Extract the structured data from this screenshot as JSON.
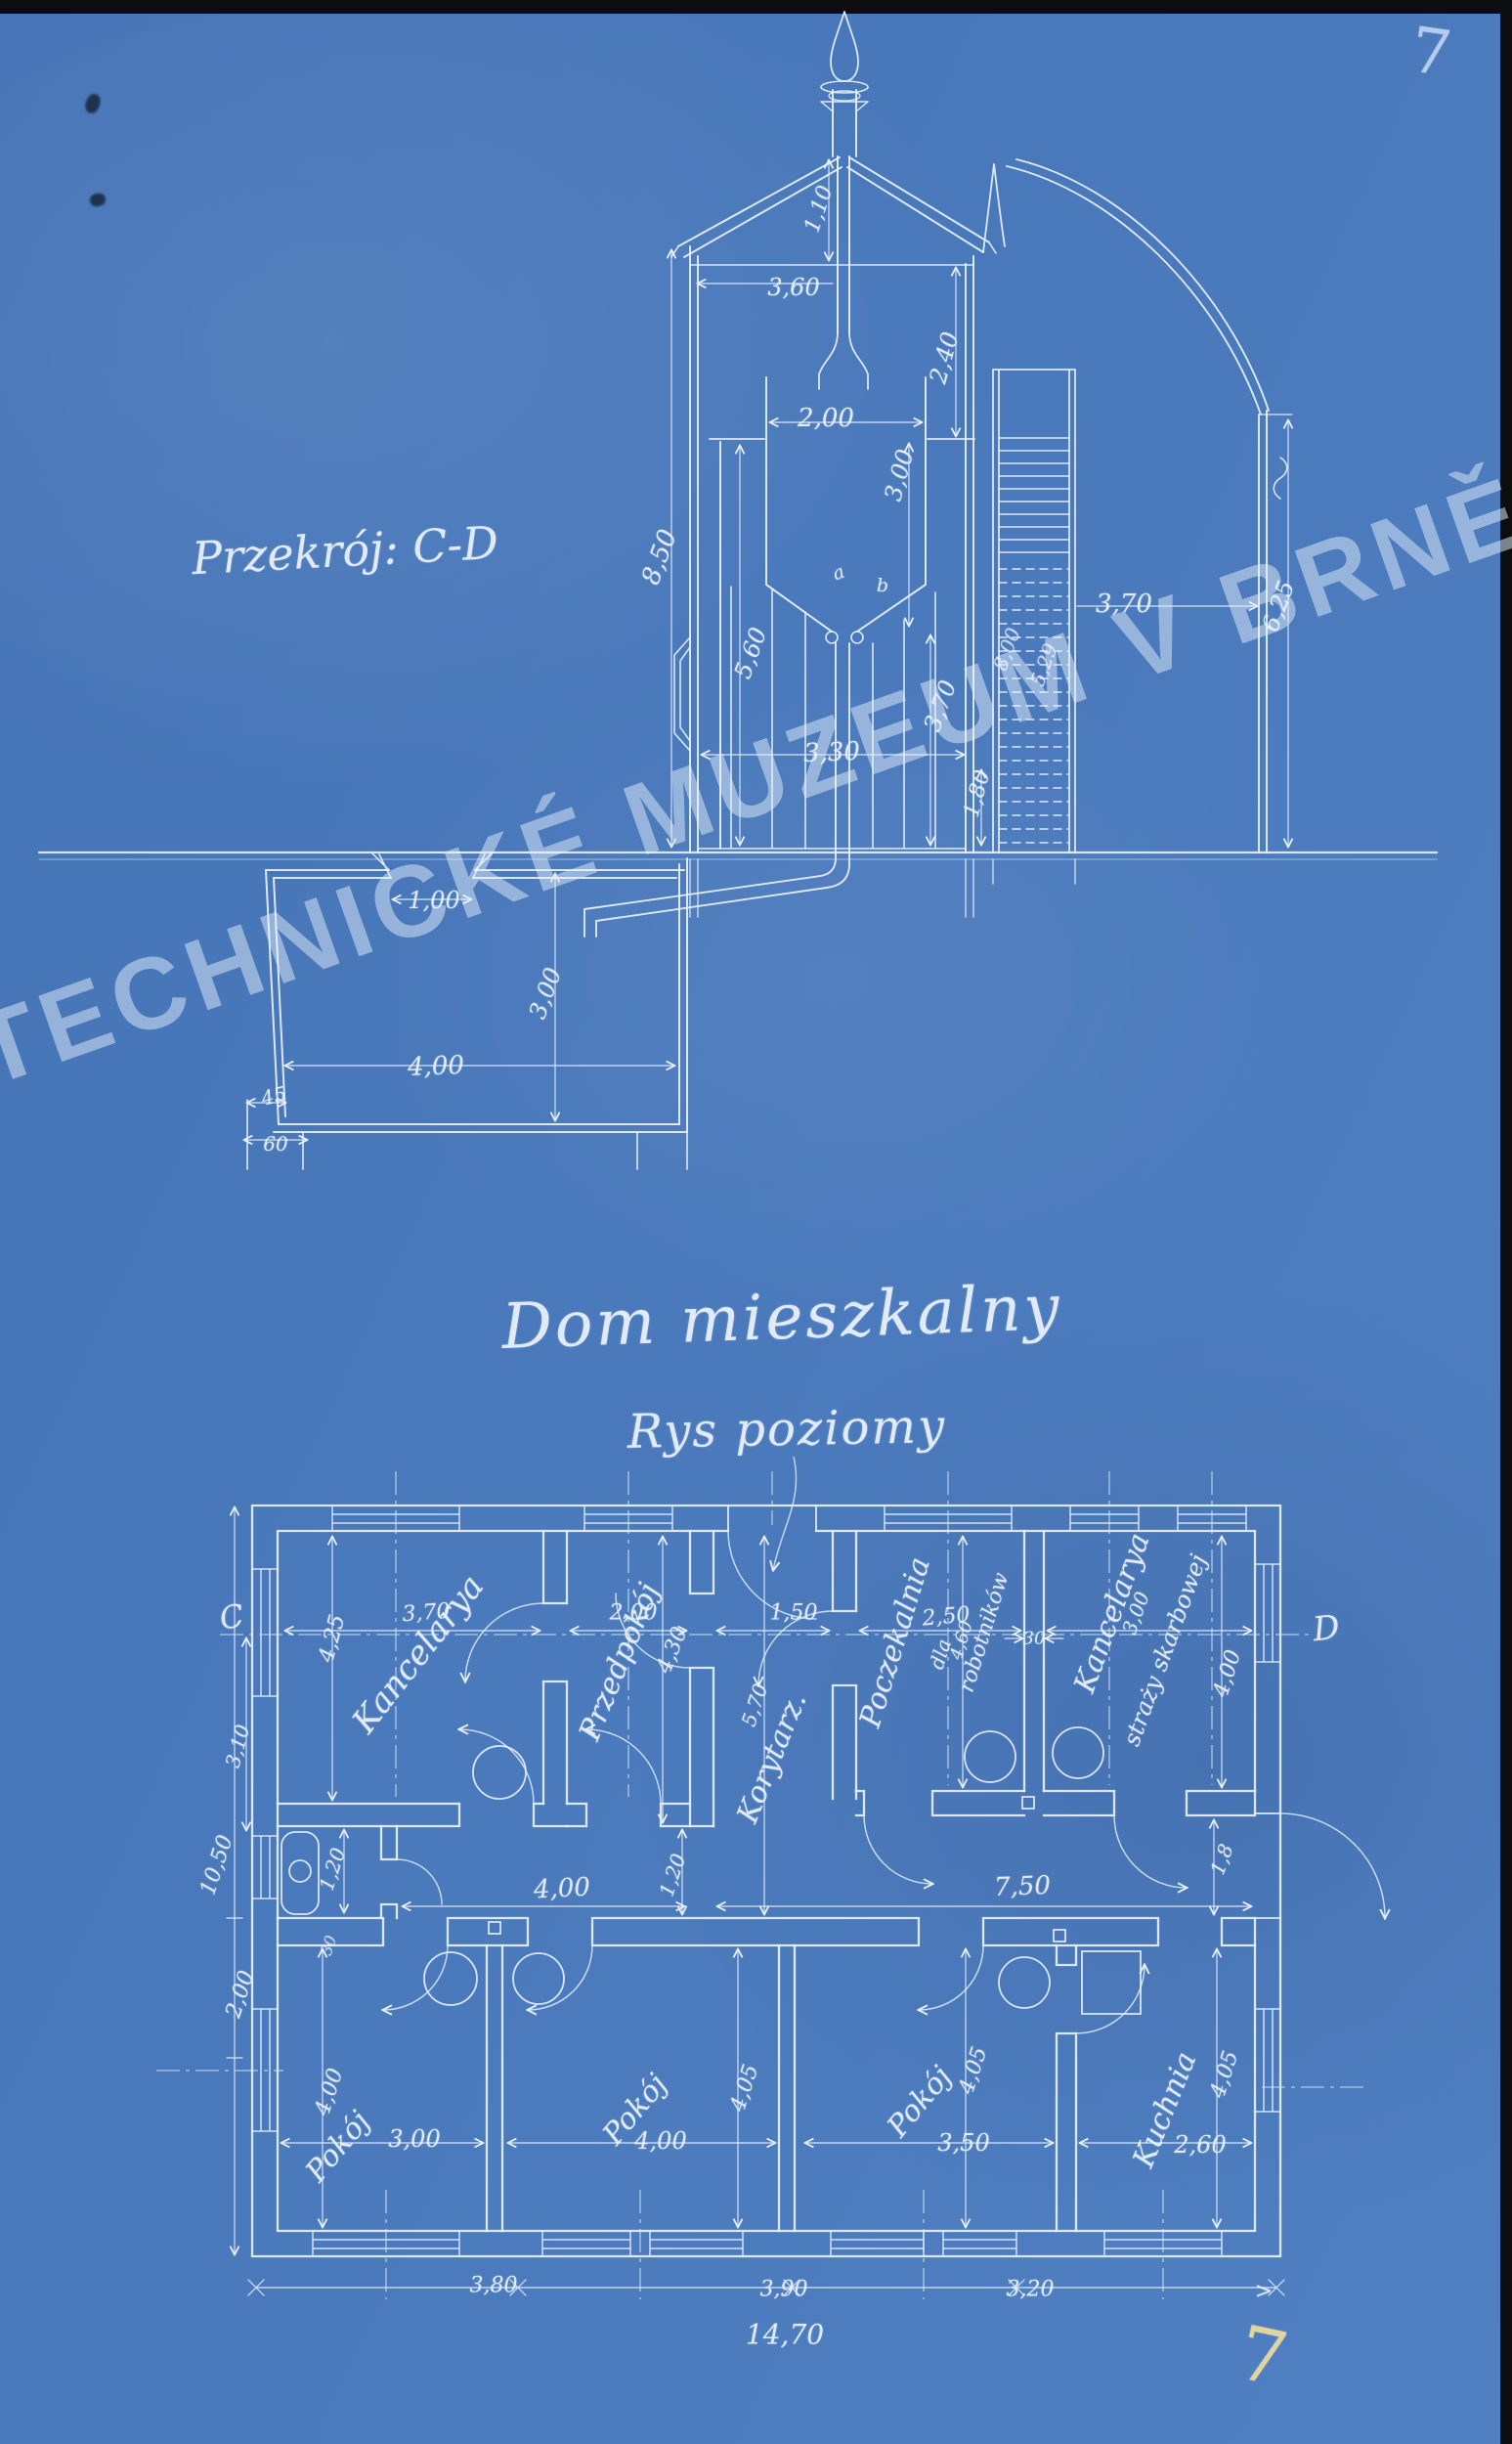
{
  "page": {
    "folio_top": "7",
    "folio_bottom": "7",
    "corner_mark": ">"
  },
  "watermark": {
    "text": "TECHNICKÉ MUZEUM V BRNĚ"
  },
  "section": {
    "title": "Przekrój: C-D",
    "dims": {
      "chimney": "1,10",
      "attic_w": "3,60",
      "roof_h": "2,40",
      "kiln_w": "2,00",
      "kiln_h": "3,00",
      "wall_h": "8,50",
      "room_h": "5,60",
      "room_w": "3,30",
      "right_h": "3,70",
      "plinth": "1,80",
      "stair_h": "8,00",
      "stair_r": "5,29",
      "stair_w": "3,70",
      "annex_h": "6,25",
      "pt_a": "a",
      "pt_b": "b"
    },
    "cellar": {
      "opening": "1,00",
      "depth": "3,00",
      "width": "4,00",
      "wall": "45",
      "footing": "60"
    }
  },
  "plan": {
    "title": "Dom mieszkalny",
    "subtitle": "Rys poziomy",
    "marker_left": "C",
    "marker_right": "D",
    "top_dims": {
      "d1": "3,70",
      "d2": "2,00",
      "d3": "1,50",
      "d4": "2,50",
      "d5": "30",
      "d6": "3,00"
    },
    "rooms": {
      "kancelarya": {
        "name": "Kancelarya",
        "h": "4,25"
      },
      "przedpokoj": {
        "name": "Przedpokój",
        "h": "4,30"
      },
      "korytarz": {
        "name": "Korytarz.",
        "h": "5,70"
      },
      "poczekalnia": {
        "l1": "Poczekalnia",
        "l2": "dla",
        "l3": "robotników",
        "h": "4,60"
      },
      "kanc_strazy": {
        "l1": "Kancelarya",
        "l2": "straży skarbowej",
        "h": "4,00",
        "door": "1,8"
      },
      "pokoj1": {
        "name": "Pokój",
        "w": "3,00",
        "h": "4,00"
      },
      "pokoj2": {
        "name": "Pokój",
        "w": "4,00",
        "h": "4,05"
      },
      "pokoj3": {
        "name": "Pokój",
        "w": "3,50",
        "h": "4,05"
      },
      "kuchnia": {
        "name": "Kuchnia",
        "w": "2,60",
        "h": "4,05"
      }
    },
    "side_dims": {
      "left_total": "10,50",
      "left_lower": "2,00",
      "left_room": "3,10",
      "wc_w": "1,20",
      "wc_wall": "30",
      "door_w": "1,20",
      "hall_left": "4,00",
      "hall_right": "7,50"
    },
    "bottom_dims": {
      "b1": "3,80",
      "b2": "3,90",
      "b3": "3,20",
      "total": "14,70"
    }
  }
}
